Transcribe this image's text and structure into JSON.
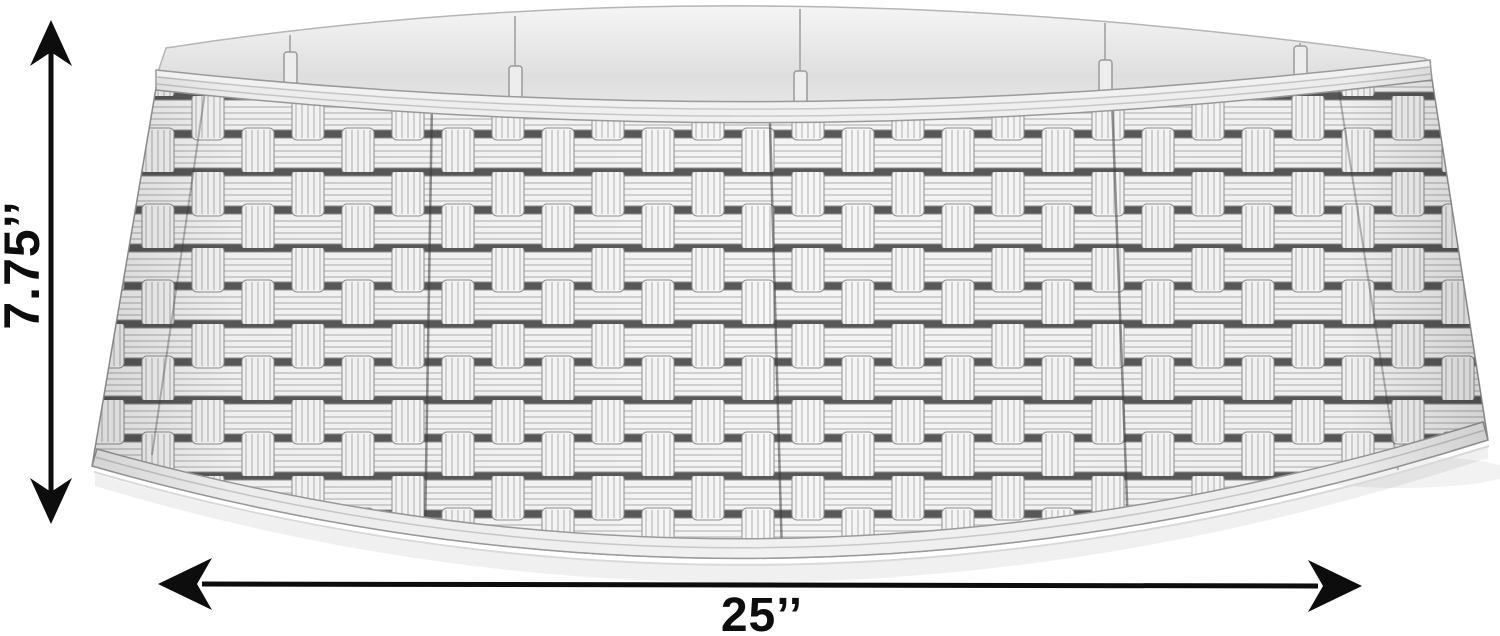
{
  "scene": {
    "description": "White resin wicker basket-weave tree collar ring shown on a plain white background with height and diameter dimension arrows",
    "background_color": "#ffffff"
  },
  "product": {
    "label": "wicker tree collar",
    "colors": {
      "strap": "#f4f4f4",
      "strap_ridge": "#c4c4c4",
      "weave_gap_shadow": "#585858",
      "inner_ring": "#e9e9e9",
      "molding": "#f1f1f1",
      "outline": "#8f8f8f"
    }
  },
  "dimensions": {
    "height_label": "7.75’’",
    "width_label": "25’’",
    "annotation_color": "#0d0d0d"
  }
}
